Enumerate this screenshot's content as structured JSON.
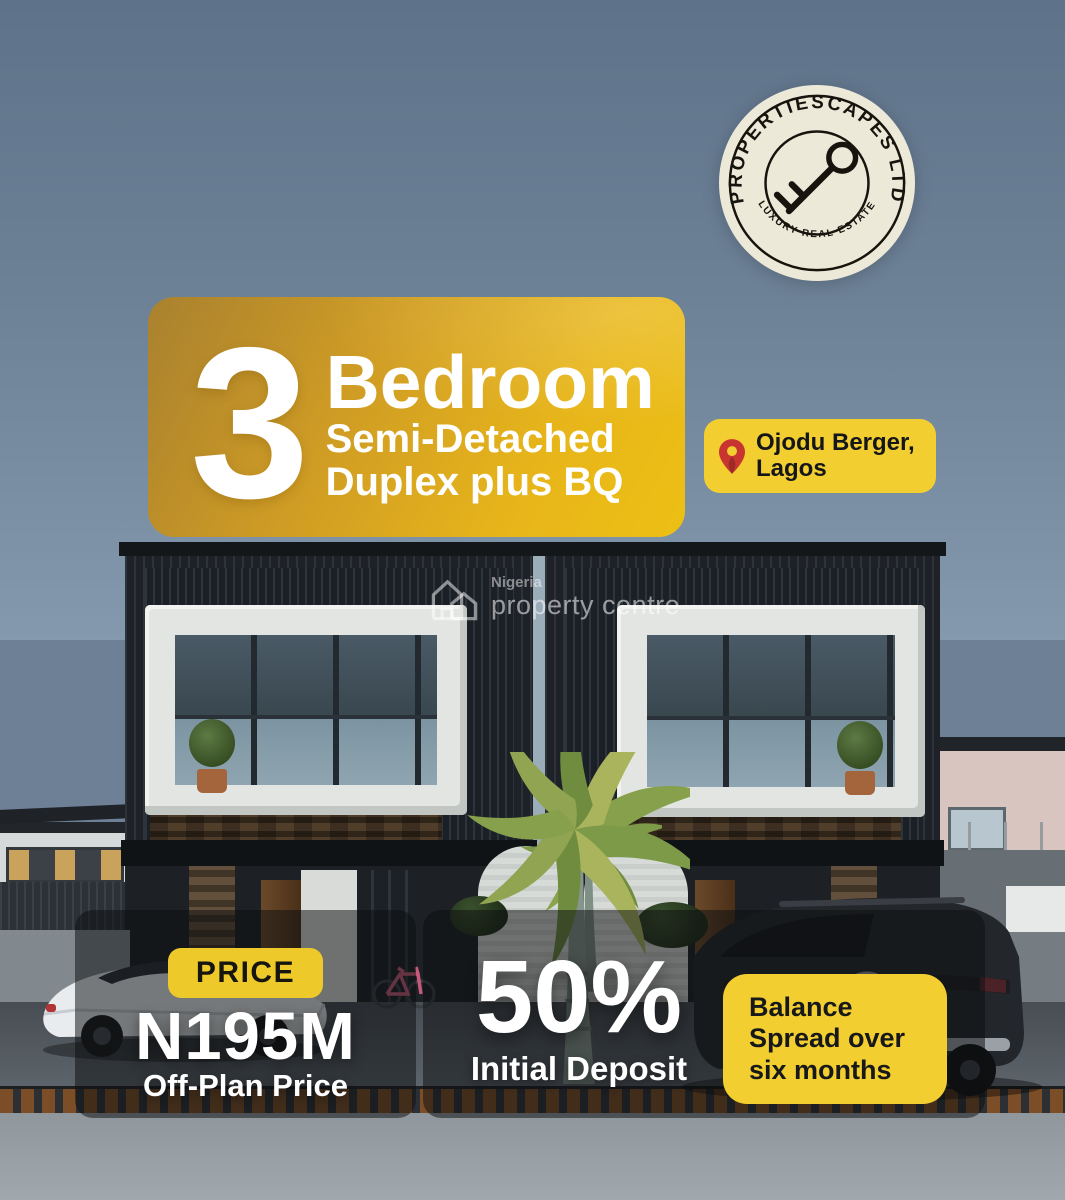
{
  "brand_logo": {
    "circle_text_top": "PROPERTIESCAPES LTD",
    "circle_text_bottom": "LUXURY REAL ESTATE",
    "icon": "key-icon",
    "bg_color": "#EDE9D8",
    "ink_color": "#17140E"
  },
  "banner": {
    "number": "3",
    "title": "Bedroom",
    "subtitle_line1": "Semi-Detached",
    "subtitle_line2": "Duplex plus BQ",
    "gradient_start": "#A9812F",
    "gradient_end": "#EDC014",
    "text_color": "#FFFFFF"
  },
  "location_badge": {
    "icon": "map-pin-icon",
    "line1": "Ojodu Berger,",
    "line2": "Lagos",
    "bg_color": "#F2CE31",
    "text_color": "#15161A",
    "pin_color": "#C8342F"
  },
  "watermark": {
    "icon": "house-icon",
    "line1": "Nigeria",
    "line2": "property centre"
  },
  "price_panel": {
    "chip_label": "PRICE",
    "chip_bg": "#EDC92A",
    "value": "N195M",
    "caption": "Off-Plan Price"
  },
  "deposit_panel": {
    "value": "50%",
    "caption": "Initial Deposit"
  },
  "balance_badge": {
    "line1": "Balance",
    "line2": "Spread over",
    "line3": "six months",
    "bg_color": "#F2CE31",
    "text_color": "#17181A"
  },
  "scene": {
    "subject": "black semi-detached duplex with white box windows, palm tree, white car and black SUV",
    "sky_top": "#5E7289",
    "sky_bottom": "#8499AD",
    "panel_overlay": "rgba(13,15,18,0.52)"
  }
}
